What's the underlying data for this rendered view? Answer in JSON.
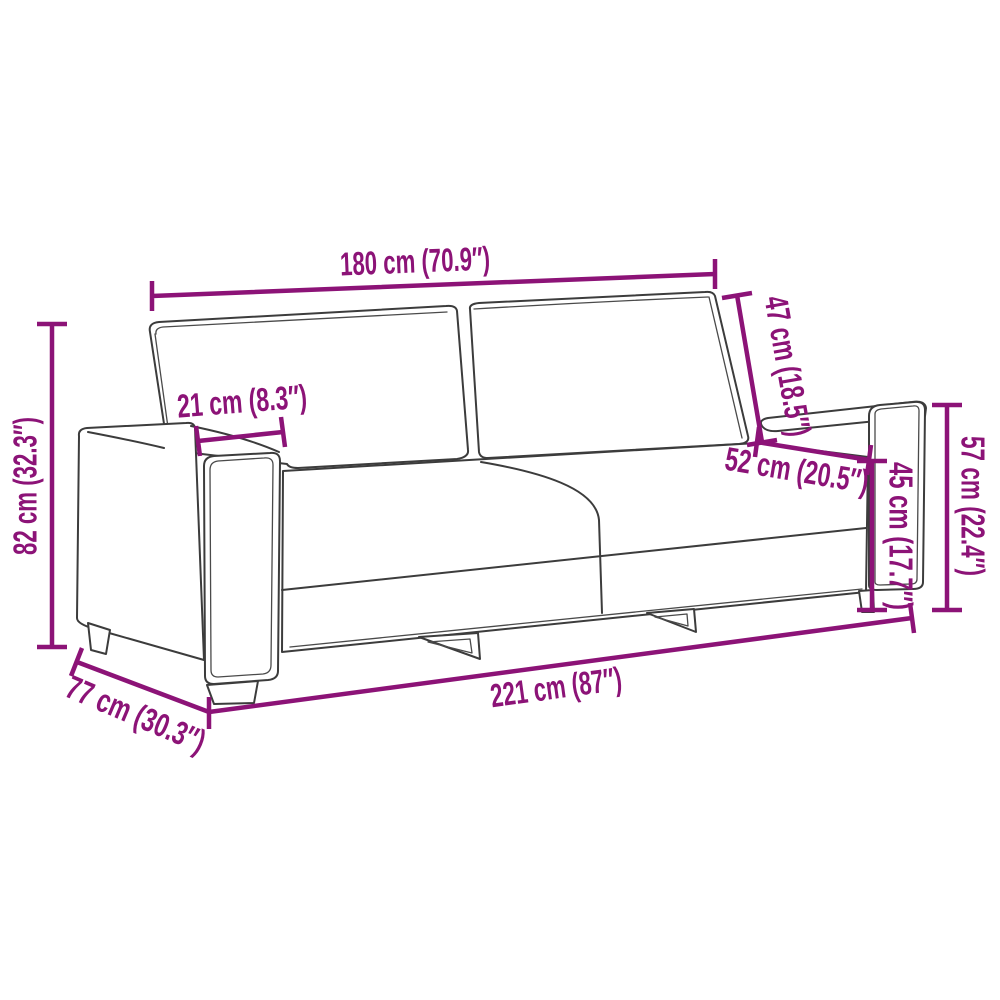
{
  "diagram": {
    "type": "product-dimension-diagram",
    "subject": "3-seater sofa line drawing",
    "accent_color": "#8C1377",
    "outline_color": "#3C3C3C",
    "background_color": "#FFFFFF",
    "dims": [
      {
        "name": "top-width",
        "label": "180 cm (70.9″)",
        "cm": 180,
        "inches": "70.9"
      },
      {
        "name": "backrest-slant",
        "label": "47 cm (18.5″)",
        "cm": 47,
        "inches": "18.5"
      },
      {
        "name": "armrest-width",
        "label": "21 cm (8.3″)",
        "cm": 21,
        "inches": "8.3"
      },
      {
        "name": "seat-depth",
        "label": "52 cm (20.5″)",
        "cm": 52,
        "inches": "20.5"
      },
      {
        "name": "seat-height",
        "label": "45 cm (17.7″)",
        "cm": 45,
        "inches": "17.7"
      },
      {
        "name": "armrest-height",
        "label": "57 cm (22.4″)",
        "cm": 57,
        "inches": "22.4"
      },
      {
        "name": "total-height",
        "label": "82 cm (32.3″)",
        "cm": 82,
        "inches": "32.3"
      },
      {
        "name": "depth",
        "label": "77 cm (30.3″)",
        "cm": 77,
        "inches": "30.3"
      },
      {
        "name": "total-width",
        "label": "221 cm (87″)",
        "cm": 221,
        "inches": "87"
      }
    ]
  }
}
